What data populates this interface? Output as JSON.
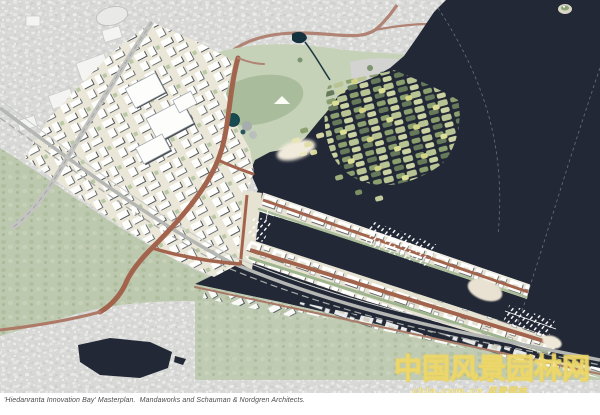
{
  "caption": "'Hiedanranta Innovation Bay' Masterplan.  Mandaworks and Schauman & Nordgren Architects.",
  "watermark": {
    "text": "中国风景园林网",
    "subtext": "chla.com.cn 风景园林",
    "color": "#f0da5e"
  },
  "palette": {
    "water": "#222836",
    "existing_city_aerial": "#d8d9d7",
    "forest_green": "#bdc9af",
    "park_green": "#c6d2b8",
    "masterplan_ground": "#eae7d8",
    "building_white": "#ffffff",
    "building_shadow": "#474c54",
    "road_red_brown": "#a3644e",
    "rail_gray": "#b5b7b4",
    "sand": "#f1ebdc",
    "wetland_greens": [
      "#8ba06e",
      "#b9c494",
      "#66795a",
      "#ccd3a3",
      "#d9d98a"
    ]
  }
}
